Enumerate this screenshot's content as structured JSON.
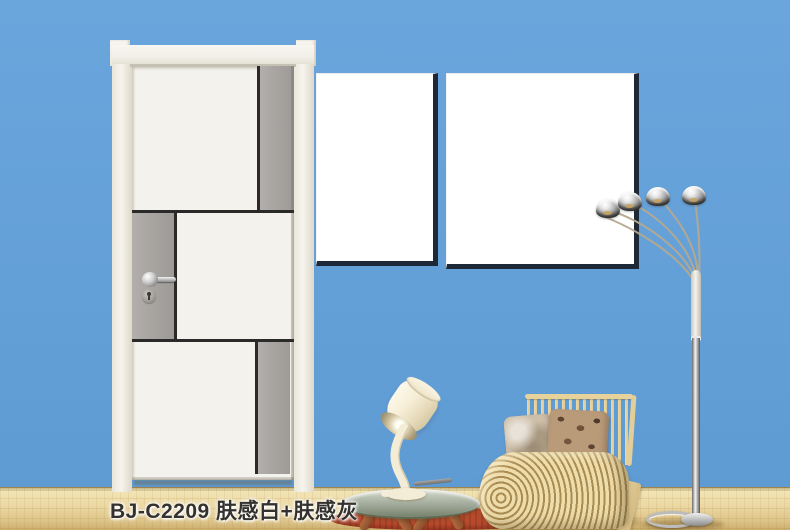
{
  "caption": {
    "text": "BJ-C2209 肤感白+肤感灰",
    "model_code": "BJ-C2209",
    "finish": "肤感白+肤感灰"
  },
  "palette": {
    "wall_blue": "#64a0d8",
    "door_white": "#f4f2ec",
    "door_grey": "#a9a5a2",
    "frame_cream": "#f1efe7",
    "groove_dark": "#2a2a28",
    "canvas_white": "#ffffff",
    "canvas_shadow": "#1d2936",
    "floor_wood": "#ead7a2",
    "rug_red": "#b94b2d",
    "chair_wood": "#ecd8a6",
    "chrome": "#c9c9c9"
  },
  "scene_objects": [
    "two-tone-interior-door",
    "blank-wall-canvas-pair",
    "five-arm-arc-floor-lamp",
    "wood-slat-lounge-chair",
    "patterned-pillows",
    "round-glass-side-table",
    "pouring-bucket-table-lamp",
    "red-rug",
    "wood-floor"
  ]
}
